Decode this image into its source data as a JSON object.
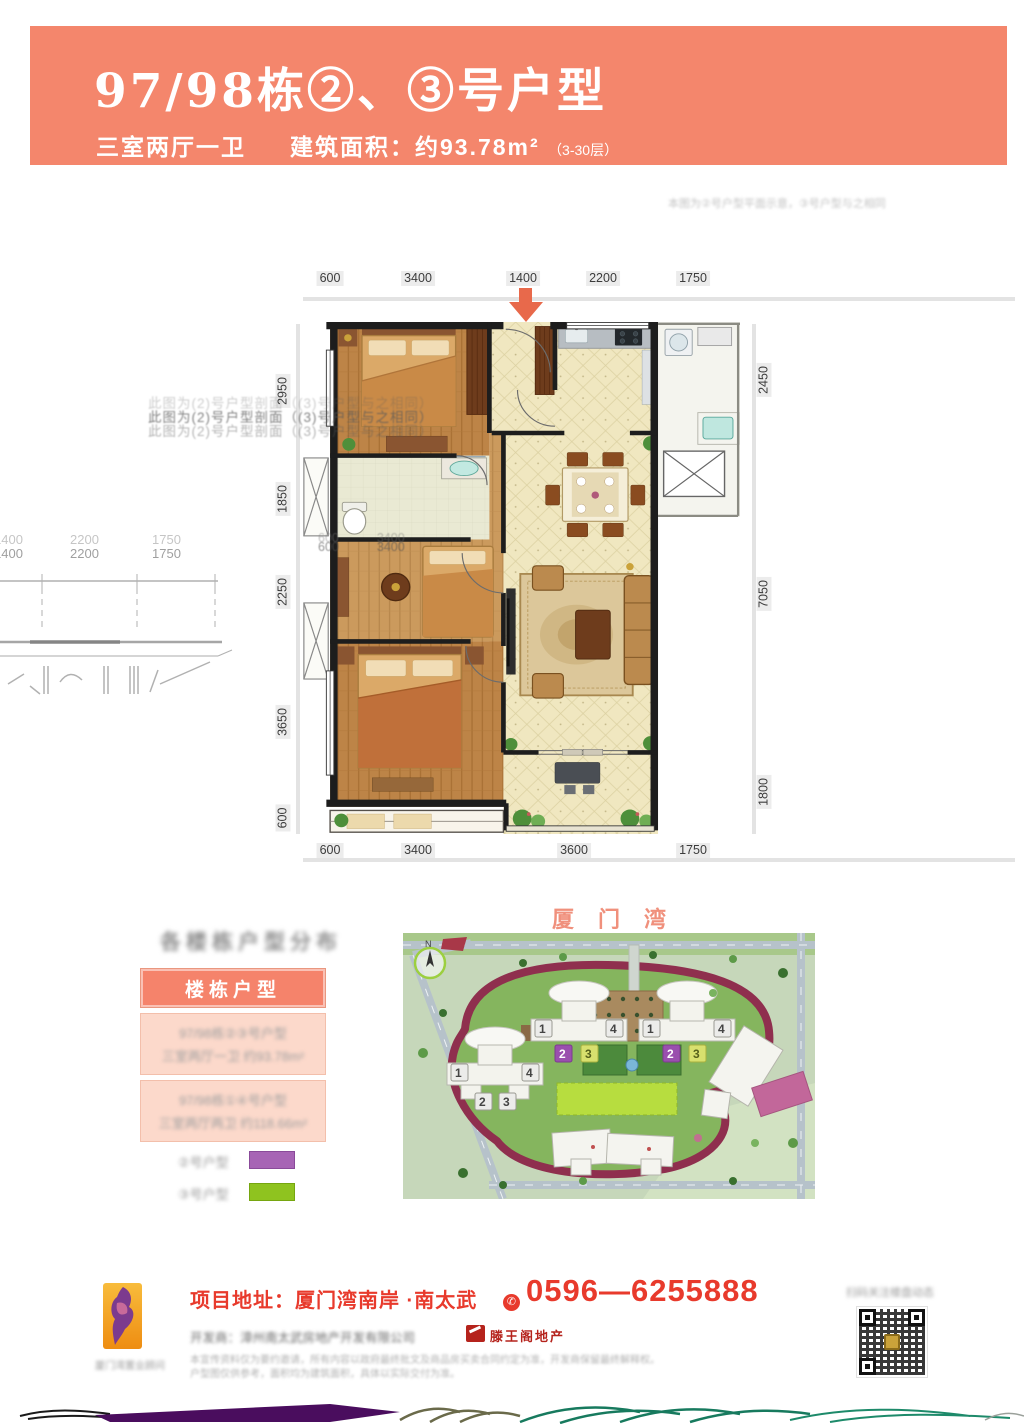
{
  "colors": {
    "header_bg": "#f4866c",
    "accent_red": "#e83a2c",
    "brand_red": "#b5231c",
    "legend_purple": "#a764b5",
    "legend_green": "#8fc31f",
    "map_unit2": "#9a4fae",
    "map_unit3": "#d8e06e",
    "entry_arrow": "#e8694b",
    "table_header_bg": "#f5836b",
    "table_row_bg": "#fcd9cb"
  },
  "header": {
    "title": "97/98栋②、③号户型",
    "subtitle_type": "三室两厅一卫",
    "subtitle_area": "建筑面积：约93.78m²",
    "subtitle_floors": "（3-30层）"
  },
  "top_note": {
    "text_blurred": "本图为②号户型平面示意，③号户型与之相同"
  },
  "floorplan": {
    "dims_top": [
      "600",
      "3400",
      "1400",
      "2200",
      "1750"
    ],
    "dims_bottom": [
      "600",
      "3400",
      "3600",
      "1750"
    ],
    "dims_left": [
      "2950",
      "1850",
      "2250",
      "3650",
      "600"
    ],
    "dims_right": [
      "2450",
      "7050",
      "1800"
    ],
    "ghost_dims": [
      "1400",
      "2200",
      "1750"
    ],
    "ghost_dim_a": "600",
    "ghost_dim_b": "3400",
    "ghost_note_blurred": "此图为(2)号户型剖面（(3)号户型与之相同）"
  },
  "site_map": {
    "title": "厦门湾",
    "compass_label": "N",
    "chip_1": "1",
    "chip_2": "2",
    "chip_3": "3",
    "chip_4": "4"
  },
  "left_panel": {
    "title_blurred": "各楼栋户型分布",
    "table": {
      "header": "楼栋户型",
      "rows": [
        {
          "line1_blurred": "97/98栋②③号户型",
          "line2_blurred": "三室两厅一卫 约93.78m²"
        },
        {
          "line1_blurred": "97/98栋①④号户型",
          "line2_blurred": "三室两厅两卫 约118.66m²"
        }
      ]
    },
    "legend": [
      {
        "label_blurred": "②号户型",
        "color": "#a764b5"
      },
      {
        "label_blurred": "③号户型",
        "color": "#8fc31f"
      }
    ]
  },
  "footer": {
    "address": "项目地址：厦门湾南岸 ·南太武",
    "phone_icon_glyph": "✆",
    "phone": "0596—6255888",
    "brand": "滕王阁地产",
    "logo_caption_blurred": "厦门湾置业顾问",
    "brand_line_blurred": "开发商：漳州南太武房地产开发有限公司",
    "fine_print_1_blurred": "本宣传资料仅为要约邀请，所有内容以政府最终批文及商品房买卖合同约定为准，开发商保留最终解释权。",
    "fine_print_2_blurred": "户型图仅供参考，面积均为建筑面积，具体以实际交付为准。",
    "qr_label_blurred": "扫码关注楼盘动态"
  }
}
